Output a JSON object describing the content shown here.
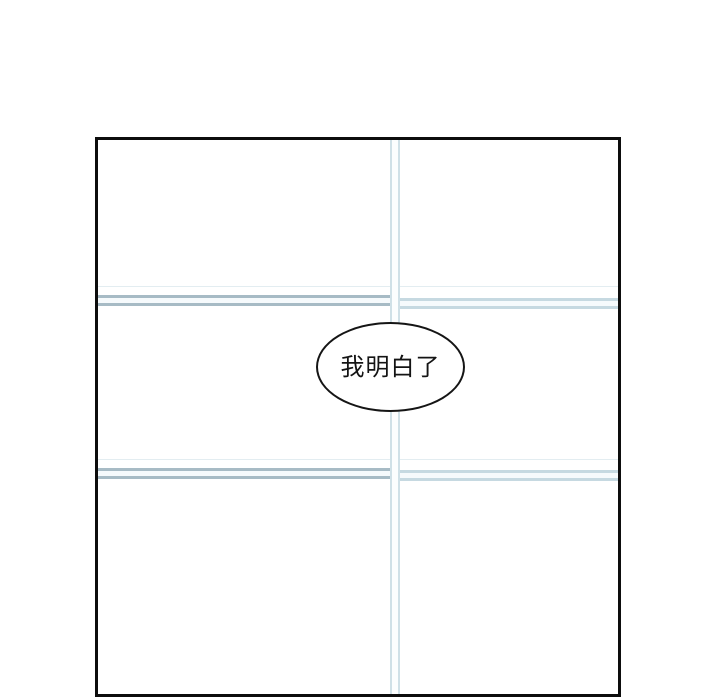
{
  "page": {
    "background_color": "#ffffff"
  },
  "panel": {
    "border_color": "#0d0d0d",
    "fill_color": "#ffffff"
  },
  "window_frame": {
    "vertical_bar_line_color": "#cfe0e7",
    "horizontal_line_color_left": "#a7bbc5",
    "horizontal_line_color_right": "#c6d9e1",
    "faint_line_color": "#e3edf1",
    "band_fill_color": "#f6fafc"
  },
  "speech_bubble": {
    "text": "我明白了",
    "outline_color": "#151515",
    "fill_color": "#ffffff",
    "text_color": "#141414"
  }
}
